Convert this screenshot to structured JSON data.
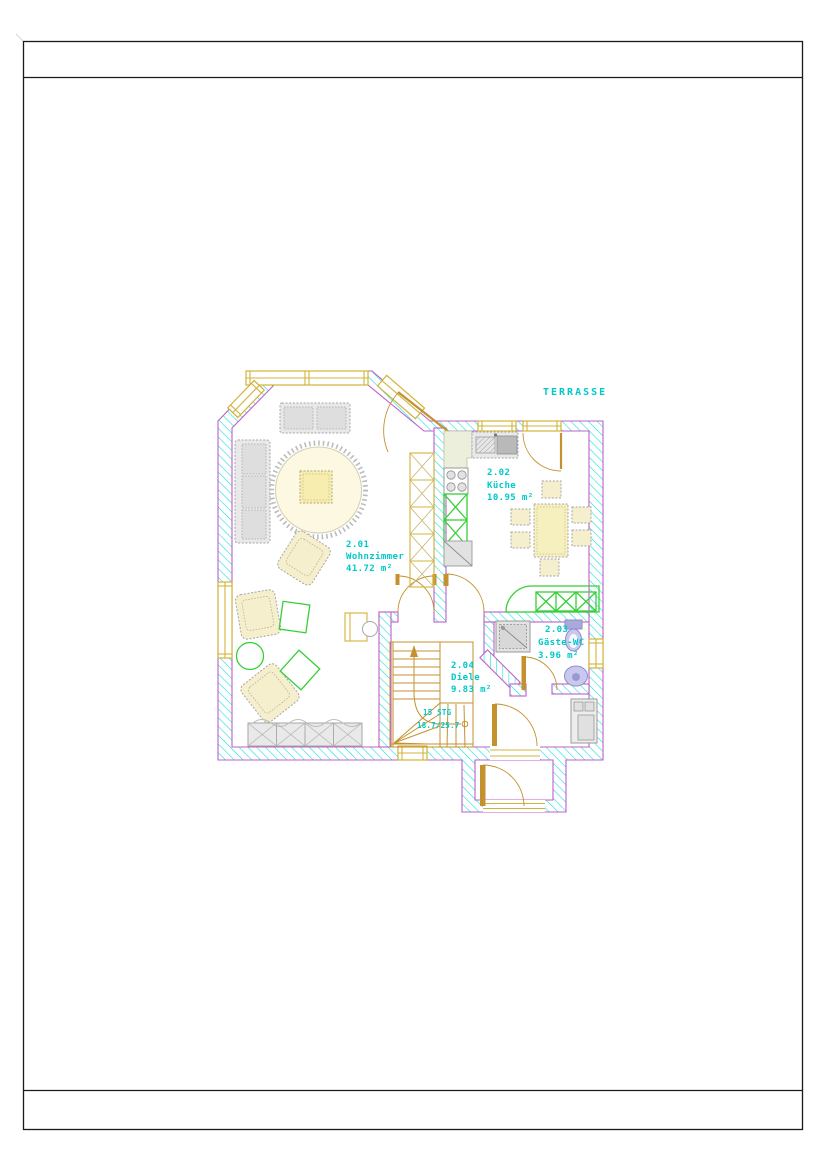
{
  "sheet": {
    "header_text": "",
    "footer_text": ""
  },
  "floor_plan": {
    "rooms": [
      {
        "number": "2.01",
        "name": "Wohnzimmer",
        "area": "41.72 m²"
      },
      {
        "number": "2.02",
        "name": "Küche",
        "area": "10.95 m²"
      },
      {
        "number": "2.03",
        "name": "Gäste-WC",
        "area": "3.96 m²"
      },
      {
        "number": "2.04",
        "name": "Diele",
        "area": "9.83 m²"
      }
    ],
    "terrace": {
      "label": "TERRASSE"
    },
    "stairs": {
      "steps": "15 STG",
      "ratio": "18.7/25.7"
    }
  },
  "colors": {
    "frame_black": "#1a1a1a",
    "wall_hatch": "#00e0e0",
    "wall_outline": "#c05fc8",
    "text_cyan": "#00c9c9",
    "window_yellow": "#d2b33a",
    "door_wood": "#c3912e",
    "terrace_tan": "#cda express05f",
    "furniture_gray": "#a6a6a6",
    "furniture_fill": "#e9e9e9",
    "cream": "#f6efcd",
    "cream_light": "#fcf8e2",
    "green": "#36cf36",
    "green_fill": "#c2da7c",
    "purple": "#8e8ec9",
    "purple_light": "#c9c9ef",
    "counter_green": "#ebefdb"
  }
}
